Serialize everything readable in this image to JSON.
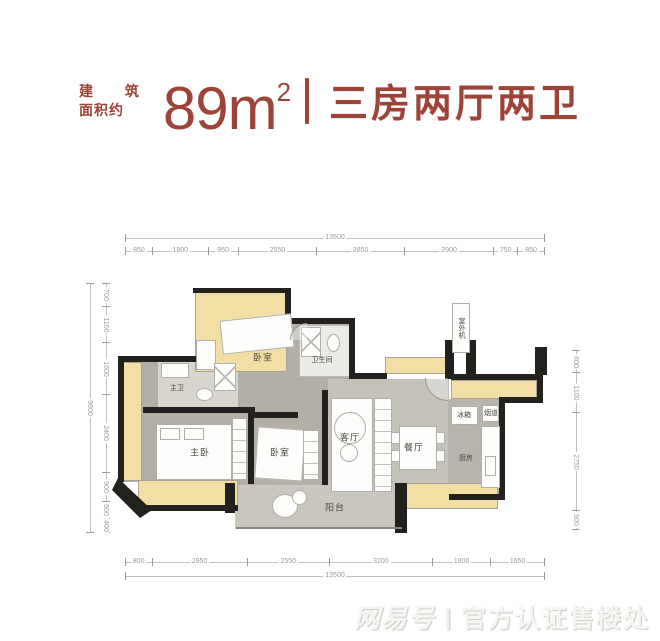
{
  "header": {
    "label_line1": "建 筑",
    "label_line2": "面积约",
    "area_value": "89m",
    "area_sup": "2",
    "divider": "|",
    "title": "三房两厅两卫",
    "accent_color": "#9e4338"
  },
  "floorplan": {
    "rooms": {
      "bedroom_top": "卧室",
      "bathroom": "卫生间",
      "master_bath": "主卫",
      "master_bedroom": "主卧",
      "bedroom_2": "卧室",
      "living": "客厅",
      "dining": "餐厅",
      "kitchen": "厨房",
      "fridge": "冰箱",
      "flue": "烟道",
      "balcony": "阳台",
      "outdoor_unit": "室外机"
    },
    "dims": {
      "top_total": "13500",
      "top": [
        "850",
        "1800",
        "950",
        "2550",
        "2850",
        "2900",
        "750",
        "850"
      ],
      "bottom_total": "13500",
      "bottom": [
        "800",
        "2950",
        "2550",
        "3200",
        "1800",
        "1650"
      ],
      "left_total": "9600",
      "left": [
        "700",
        "1100",
        "1600",
        "2400",
        "900",
        "500",
        "400"
      ],
      "right": [
        "600",
        "1100",
        "2750",
        "500"
      ]
    }
  },
  "watermark": {
    "logo": "网易号",
    "divider": "|",
    "text": "官方认证售楼处"
  }
}
